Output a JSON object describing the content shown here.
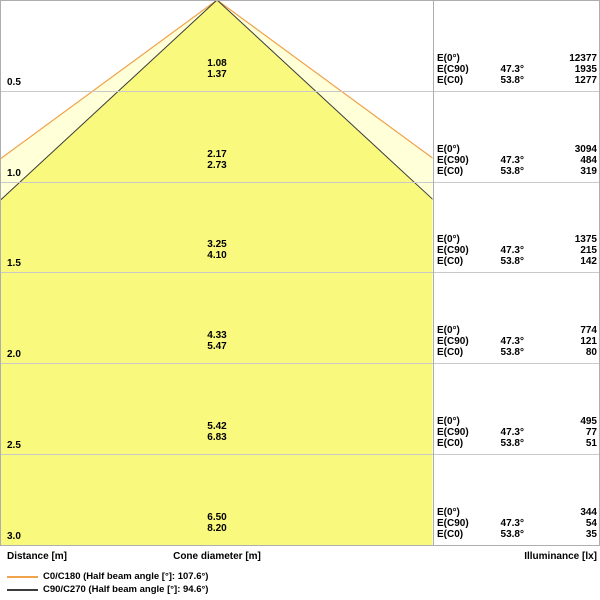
{
  "axis": {
    "distance_label": "Distance [m]",
    "cone_diameter_label": "Cone diameter [m]",
    "illuminance_label": "Illuminance [lx]"
  },
  "table": {
    "row_labels": {
      "e0": "E(0°)",
      "ec90": "E(C90)",
      "ec0": "E(C0)"
    }
  },
  "legend": [
    {
      "name": "c0-c180",
      "label": "C0/C180 (Half beam angle [°]: 107.6°)",
      "color": "#f0a24c"
    },
    {
      "name": "c90-c270",
      "label": "C90/C270 (Half beam angle [°]: 94.6°)",
      "color": "#3c3c3c"
    }
  ],
  "chart_data": {
    "type": "area",
    "title": "Light cone diagram (luminaire beam / illuminance at distance)",
    "xlabel": "Cone diameter [m]",
    "ylabel": "Distance [m]",
    "y2label": "Illuminance [lx]",
    "distance_ticks_m": [
      0.5,
      1.0,
      1.5,
      2.0,
      2.5,
      3.0
    ],
    "half_beam_angle_c0_c180_deg": 107.6,
    "half_beam_angle_c90_c270_deg": 94.6,
    "ec90_half_angle": "47.3°",
    "ec0_half_angle": "53.8°",
    "sections": [
      {
        "distance": "0.5",
        "cone_c90": "1.08",
        "cone_c0": "1.37",
        "e0": "12377",
        "ec90_angle": "47.3°",
        "ec90": "1935",
        "ec0_angle": "53.8°",
        "ec0": "1277"
      },
      {
        "distance": "1.0",
        "cone_c90": "2.17",
        "cone_c0": "2.73",
        "e0": "3094",
        "ec90_angle": "47.3°",
        "ec90": "484",
        "ec0_angle": "53.8°",
        "ec0": "319"
      },
      {
        "distance": "1.5",
        "cone_c90": "3.25",
        "cone_c0": "4.10",
        "e0": "1375",
        "ec90_angle": "47.3°",
        "ec90": "215",
        "ec0_angle": "53.8°",
        "ec0": "142"
      },
      {
        "distance": "2.0",
        "cone_c90": "4.33",
        "cone_c0": "5.47",
        "e0": "774",
        "ec90_angle": "47.3°",
        "ec90": "121",
        "ec0_angle": "53.8°",
        "ec0": "80"
      },
      {
        "distance": "2.5",
        "cone_c90": "5.42",
        "cone_c0": "6.83",
        "e0": "495",
        "ec90_angle": "47.3°",
        "ec90": "77",
        "ec0_angle": "53.8°",
        "ec0": "51"
      },
      {
        "distance": "3.0",
        "cone_c90": "6.50",
        "cone_c0": "8.20",
        "e0": "344",
        "ec90_angle": "47.3°",
        "ec90": "54",
        "ec0_angle": "53.8°",
        "ec0": "35"
      }
    ],
    "colors": {
      "cone_outer_fill": "#ffffd8",
      "cone_outer_stroke": "#f0a24c",
      "cone_inner_fill": "#f9f97d",
      "cone_inner_stroke": "#3c3c3c",
      "grid": "#c9c9c9",
      "border": "#aeaeae"
    }
  }
}
